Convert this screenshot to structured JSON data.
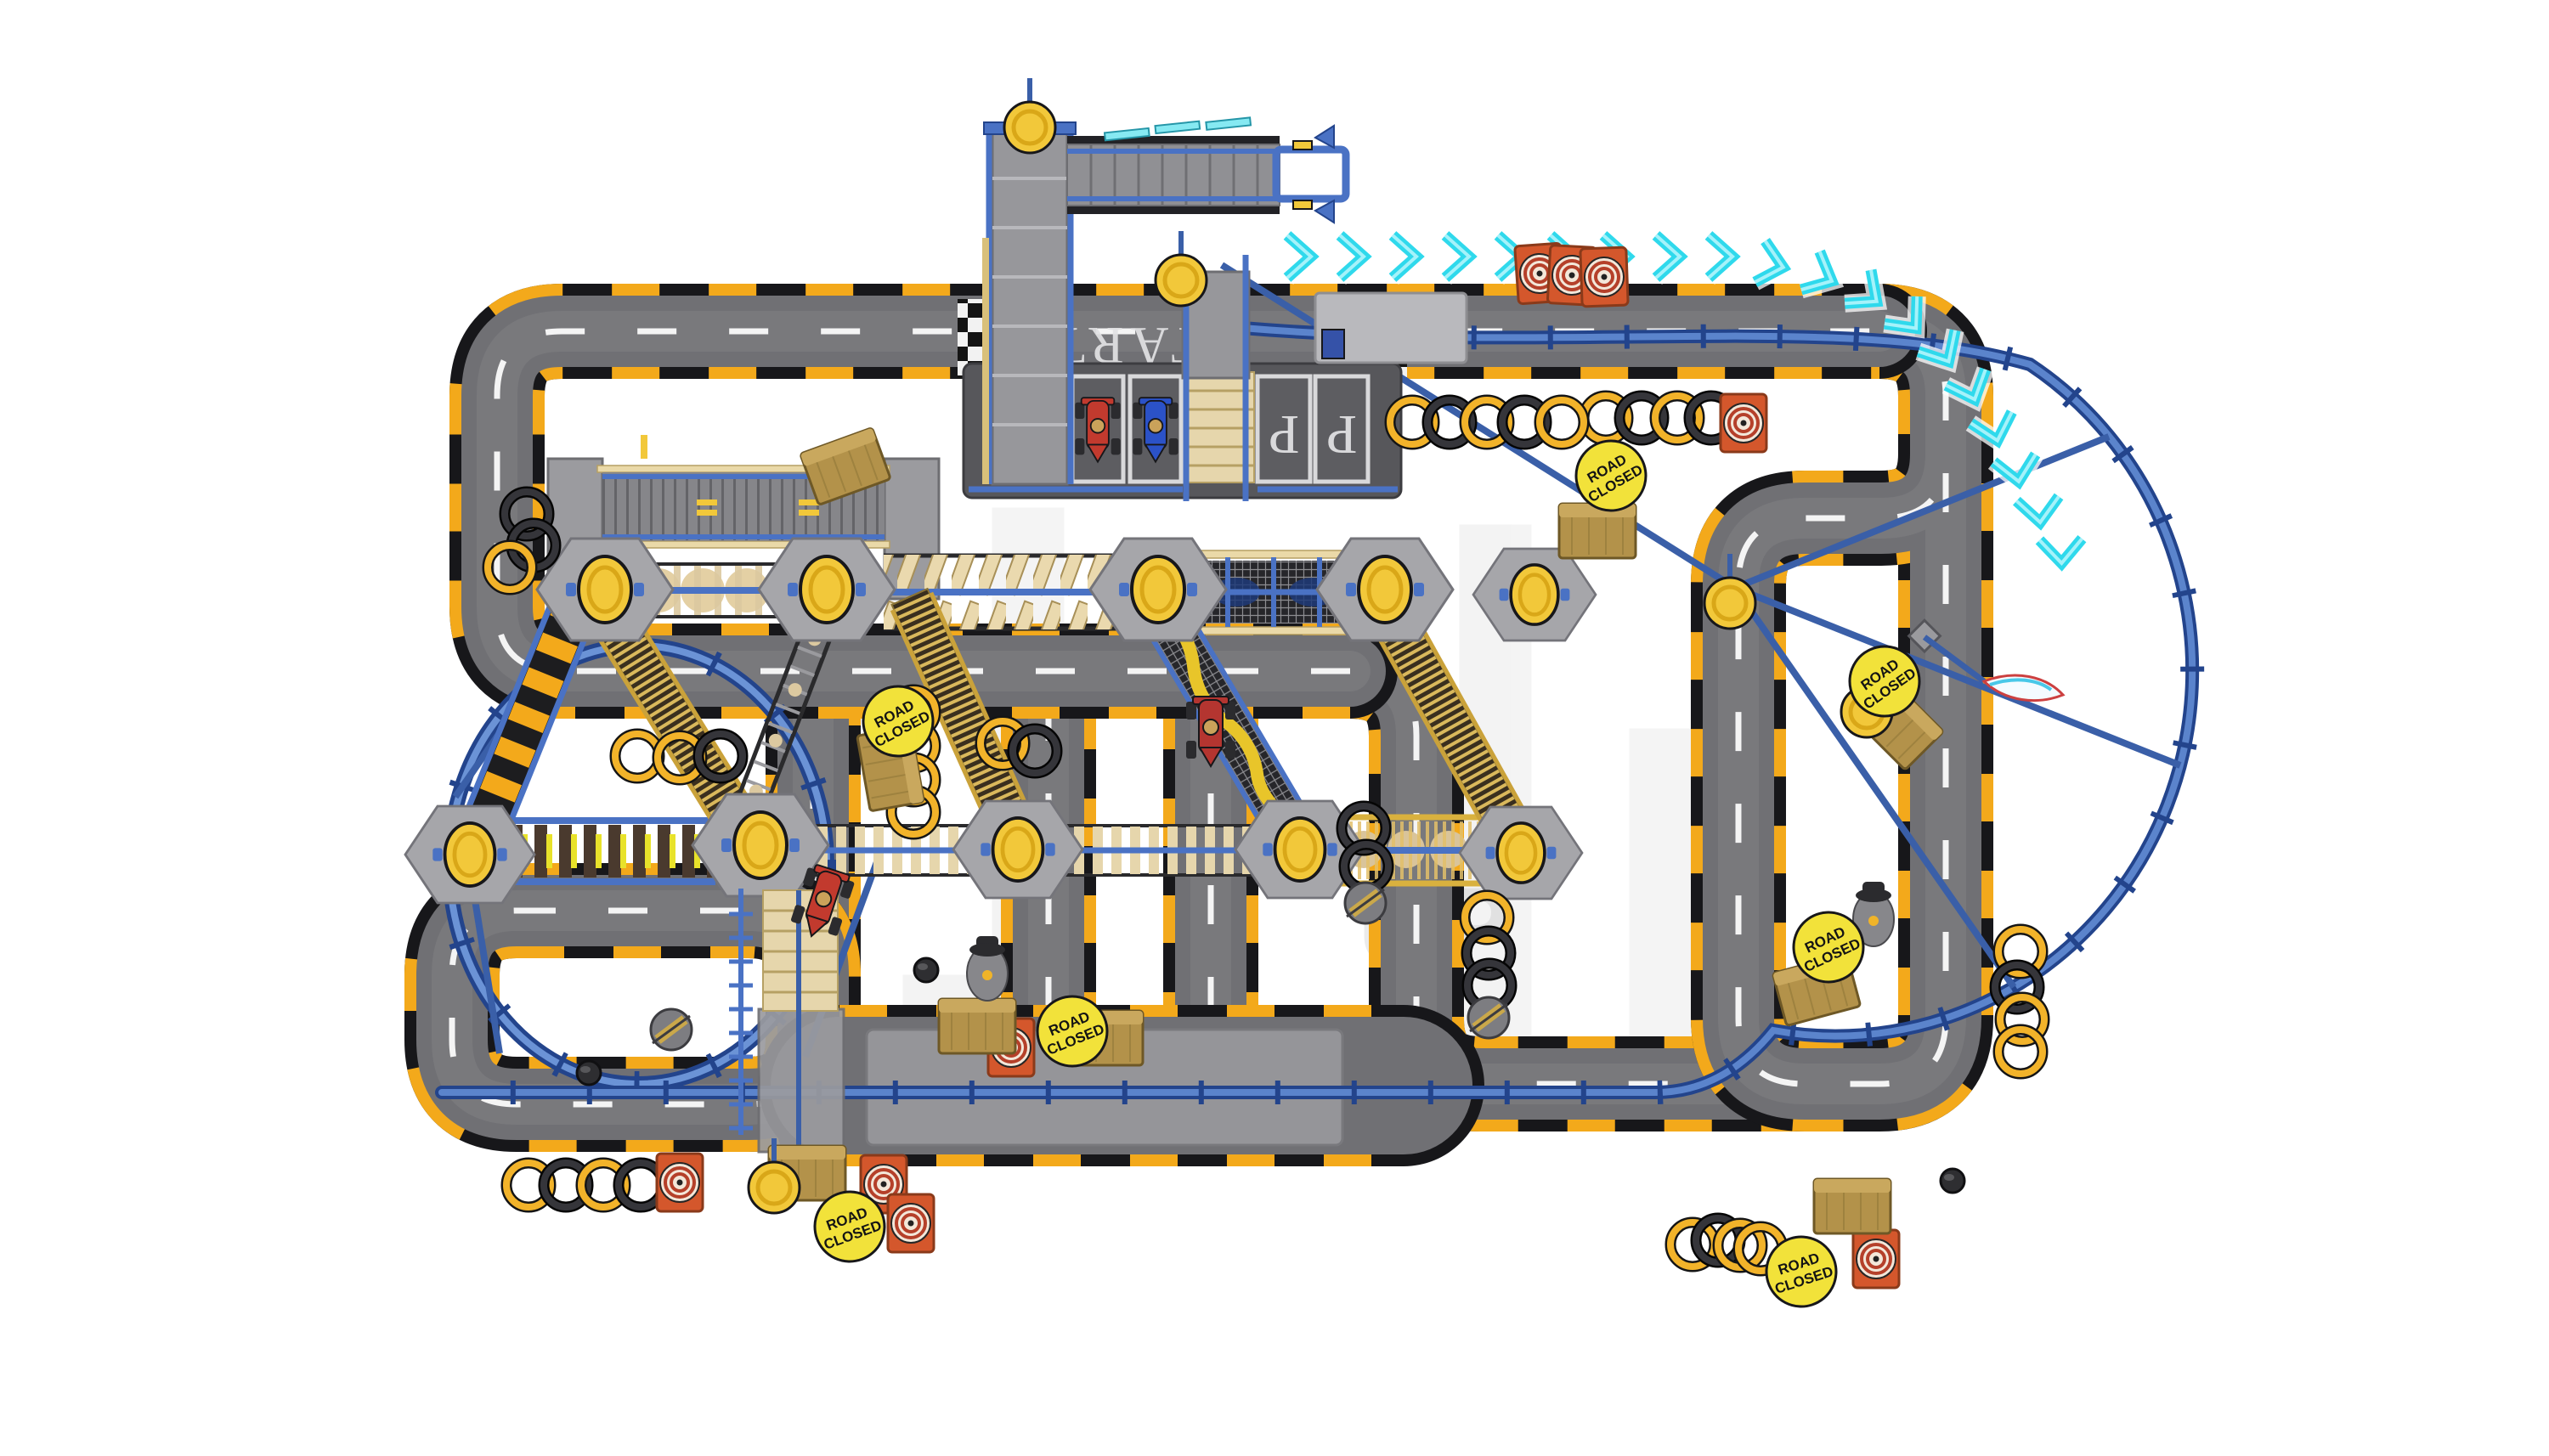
{
  "scene": {
    "description": "Top-down 3D render of a toy racing track playset with elevated bridges, ramps, towers, two big loops and obstacles on a white background",
    "background_color": "#ffffff"
  },
  "watermark": {
    "visible_text": "UP"
  },
  "road": {
    "surface_color": "#707074",
    "curb_yellow": "#f3a91b",
    "curb_black": "#17171a",
    "centerline_color": "#f4f4f4"
  },
  "road_markings": {
    "start_text": "START",
    "parking_letter": "P",
    "parking_spots": 2,
    "checkered_lines": 2
  },
  "signs": {
    "road_closed": {
      "line1": "ROAD",
      "line2": "CLOSED",
      "count": 7,
      "face_color": "#f2e23a"
    }
  },
  "direction_arrows": {
    "count": 19,
    "color": "#3fe8f4"
  },
  "obstacles": {
    "tire_rings": {
      "count": 38,
      "yellow": "#f2b32a",
      "black": "#2a2a2c"
    },
    "target_boxes": {
      "count": 9,
      "color": "#d4572c"
    },
    "crates": {
      "count": 9,
      "color": "#b3924a"
    },
    "striped_discs": {
      "count": 3
    },
    "round_bumpers": {
      "count": 3
    },
    "hat_figures": {
      "count": 2
    }
  },
  "vehicles": {
    "parked": [
      {
        "name": "red-race-car",
        "color": "#c23a2e"
      },
      {
        "name": "blue-race-car",
        "color": "#2b52c8"
      }
    ],
    "on_track": [
      {
        "name": "red-race-car",
        "color": "#c23a2e"
      },
      {
        "name": "red-race-car",
        "color": "#b43530"
      }
    ]
  },
  "structures": {
    "hex_platforms": 10,
    "towers": 3,
    "bridges": [
      "window-conveyor",
      "roller-disc-bridge",
      "paddle-bridge",
      "mesh-tunnel-bridge",
      "piston-bridge",
      "plank-bridge",
      "golden-cage-bridge",
      "top-launch-bridge"
    ],
    "ramps": [
      "checkered-ramp",
      "golden-cage-ramp",
      "ladder-ramp",
      "yellow-wave-ramp"
    ],
    "loops": [
      "left-ferris-loop",
      "right-swing-loop"
    ]
  },
  "palette": {
    "frame_blue": "#4a72c4",
    "deep_blue": "#23448c",
    "knob_yellow": "#f2c83a",
    "beige": "#e6d6ac",
    "cyan": "#3fe8f4"
  }
}
